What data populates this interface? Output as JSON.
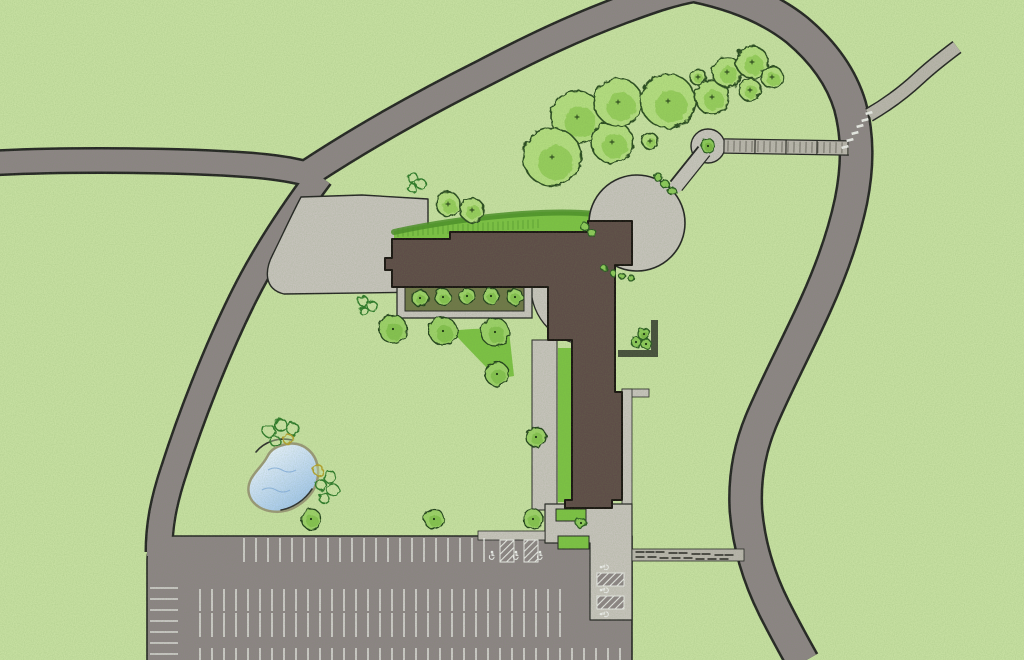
{
  "map": {
    "type": "landscape-site-plan",
    "canvas": {
      "width": 1024,
      "height": 660
    },
    "palette": {
      "grass": "#c7e0a2",
      "road": "#8d8486",
      "casing": "#242424",
      "plaza": "#c7c3bd",
      "building": "#5e4b48",
      "buildingOutline": "#1a1412",
      "lawnBright": "#7cc244",
      "lawnDark": "#4b8f28",
      "olive": "#6f7748",
      "wall": "#474f3d",
      "boardwalk": "#b9b4ad",
      "boardTick": "#5f5a55",
      "stall": "#e9e9e7",
      "dashDark": "#4c4946",
      "shore": "#9b9878",
      "ripple": "#86aede",
      "pondLight": "#f5faff",
      "pondMid": "#cfe2f7",
      "pondDeep": "#9dc3ea",
      "dot": "#1b3312",
      "ringGreen": "#2f7a2b",
      "ringYellow": "#b3a02e",
      "trees": {
        "canopy": {
          "fill": "#b4dd80",
          "inner": "#92cb58",
          "stroke": "#2c4b20"
        },
        "round": {
          "fill": "#9cd168",
          "inner": "#83c04c",
          "stroke": "#20401b"
        },
        "shrub": {
          "fill": "#8cc95a",
          "inner": "#7ab544",
          "stroke": "#2b5a22"
        }
      }
    },
    "layers": [
      {
        "name": "grass-field",
        "kind": "rect",
        "x": 0,
        "y": 0,
        "w": 1024,
        "h": 660,
        "fill": "grass"
      },
      {
        "name": "road-network",
        "kind": "roadnet",
        "casingW": 5,
        "paths": [
          {
            "id": "road-west",
            "d": "M-8,163 C70,159 180,160 250,165 C285,168 305,172 320,178",
            "w": 22
          },
          {
            "id": "road-southwest",
            "d": "M320,176 C293,212 266,252 244,296 C216,352 190,420 174,470 C163,503 159,527 159,552",
            "w": 24
          },
          {
            "id": "road-north",
            "d": "M310,172 C362,138 424,103 484,73 C534,47 574,28 622,10 C652,-1 672,-8 695,-12",
            "w": 25
          },
          {
            "id": "road-east",
            "d": "M695,-14 C738,-5 772,10 797,30 C822,51 841,76 850,106 C858,136 858,166 851,201 C843,239 830,273 816,304 C799,342 777,383 761,421 C749,450 744,479 746,511 C749,546 759,578 774,608 C784,628 794,646 803,662",
            "w": 30
          }
        ]
      },
      {
        "name": "parking-lot",
        "kind": "path",
        "d": "M147,662 L147,560 C147,545 156,537 173,536 L632,536 L632,662 Z",
        "fill": "road",
        "stroke": "casing",
        "sw": 1.6
      },
      {
        "name": "lot-entrance-blend",
        "kind": "path",
        "d": "M174,470 C163,503 159,527 159,556",
        "fill": "none",
        "stroke": "road",
        "sw": 24,
        "cap": "butt"
      },
      {
        "name": "driveway",
        "kind": "path",
        "d": "M301,197 L362,195 L428,199 L428,292 L284,294 C263,289 265,269 273,254 C281,238 291,216 301,197 Z",
        "fill": "plaza",
        "stroke": "casing",
        "sw": 1.4
      },
      {
        "name": "north-lawn",
        "kind": "path",
        "d": "M394,244 L394,231 C440,221 482,216 522,213 C552,211 576,211 594,213 L599,231 L591,241 L450,241 L450,244 Z",
        "fill": "lawnBright"
      },
      {
        "name": "north-lawn-shade",
        "kind": "path",
        "d": "M394,232 C440,222 482,217 522,214 C552,212 576,212 594,214",
        "fill": "none",
        "stroke": "lawnDark",
        "sw": 6,
        "op": 0.85
      },
      {
        "name": "hedge-ticks",
        "kind": "tickrow",
        "x1": 398,
        "x2": 540,
        "step": 5,
        "y1": 228,
        "y2": 219,
        "len": 9,
        "stroke": "lawnDark",
        "sw": 1,
        "op": 0.6
      },
      {
        "name": "circle-plaza",
        "kind": "circle",
        "cx": 637,
        "cy": 223,
        "r": 48,
        "fill": "plaza",
        "stroke": "casing",
        "sw": 1.6
      },
      {
        "name": "garden-node",
        "kind": "circle",
        "cx": 708,
        "cy": 146,
        "r": 17,
        "fill": "plaza",
        "stroke": "casing",
        "sw": 1.4
      },
      {
        "name": "node-link-casing",
        "kind": "path",
        "d": "M676,186 L704,151",
        "fill": "none",
        "stroke": "casing",
        "sw": 16,
        "cap": "butt"
      },
      {
        "name": "node-link",
        "kind": "path",
        "d": "M674,189 L706,149",
        "fill": "none",
        "stroke": "plaza",
        "sw": 13,
        "cap": "butt"
      },
      {
        "name": "boardwalk",
        "kind": "boardwalk",
        "x1": 724,
        "y1": 146,
        "x2": 849,
        "y2": 148,
        "w": 13
      },
      {
        "name": "ne-trail-casing",
        "kind": "path",
        "d": "M869,115 C888,104 904,92 919,78 C933,65 945,56 957,47",
        "fill": "none",
        "stroke": "casing",
        "sw": 15,
        "cap": "butt"
      },
      {
        "name": "ne-trail",
        "kind": "path",
        "d": "M869,115 C888,104 904,92 919,78 C933,65 945,56 957,47",
        "fill": "none",
        "stroke": "boardwalk",
        "sw": 12,
        "cap": "butt"
      },
      {
        "name": "crosswalk-marks",
        "kind": "dashes",
        "w": 7,
        "h": 2.6,
        "fill": "stall",
        "items": [
          [
            845,
            147,
            -15
          ],
          [
            850,
            140,
            -15
          ],
          [
            855,
            133,
            -15
          ],
          [
            860,
            126,
            -15
          ],
          [
            865,
            120,
            -15
          ],
          [
            869,
            113,
            -15
          ]
        ]
      },
      {
        "name": "terrace",
        "kind": "path",
        "d": "M589,287 L531,287 A58,58 0 0 0 589,345 Z",
        "fill": "plaza",
        "stroke": "casing",
        "sw": 1.3
      },
      {
        "name": "wing-walkway",
        "kind": "rect",
        "x": 532,
        "y": 340,
        "w": 25,
        "h": 170,
        "fill": "plaza",
        "stroke": "casing",
        "sw": 1
      },
      {
        "name": "wing-lawn-strip",
        "kind": "rect",
        "x": 558,
        "y": 348,
        "w": 13,
        "h": 154,
        "fill": "lawnBright"
      },
      {
        "name": "courtyard-lawn-wedge",
        "kind": "path",
        "d": "M452,331 C472,328 492,328 509,331 L514,376 L497,379 C481,361 465,346 452,331 Z",
        "fill": "lawnBright"
      },
      {
        "name": "planter-border-walk",
        "kind": "rect",
        "x": 397,
        "y": 279,
        "w": 135,
        "h": 39,
        "fill": "plaza",
        "stroke": "casing",
        "sw": 1.3
      },
      {
        "name": "planter-bed",
        "kind": "rect",
        "x": 405,
        "y": 286,
        "w": 119,
        "h": 25,
        "fill": "olive",
        "stroke": "casing",
        "sw": 1
      },
      {
        "name": "east-sidewalk-spur",
        "kind": "rect",
        "x": 622,
        "y": 389,
        "w": 27,
        "h": 8,
        "fill": "plaza",
        "stroke": "casing",
        "sw": 0.8
      },
      {
        "name": "east-sidewalk",
        "kind": "rect",
        "x": 622,
        "y": 389,
        "w": 10,
        "h": 123,
        "fill": "plaza",
        "stroke": "casing",
        "sw": 0.8
      },
      {
        "name": "garden-wall-vertical",
        "kind": "rect",
        "x": 651,
        "y": 320,
        "w": 7,
        "h": 37,
        "fill": "wall"
      },
      {
        "name": "garden-wall-horizontal",
        "kind": "rect",
        "x": 618,
        "y": 350,
        "w": 40,
        "h": 7,
        "fill": "wall"
      },
      {
        "name": "entry-plaza",
        "kind": "path",
        "d": "M545,504 L632,504 L632,620 L590,620 L590,543 L545,543 Z",
        "fill": "plaza",
        "stroke": "casing",
        "sw": 1.2
      },
      {
        "name": "entry-sidewalk-west",
        "kind": "rect",
        "x": 478,
        "y": 531,
        "w": 67,
        "h": 9,
        "fill": "plaza",
        "stroke": "casing",
        "sw": 0.8
      },
      {
        "name": "entry-crosswalk",
        "kind": "rect",
        "x": 632,
        "y": 549,
        "w": 112,
        "h": 12,
        "fill": "boardwalk",
        "stroke": "casing",
        "sw": 0.8
      },
      {
        "name": "entry-crosswalk-pavers",
        "kind": "dashes",
        "w": 9,
        "h": 2,
        "fill": "dashDark",
        "items": [
          [
            640,
            552,
            0
          ],
          [
            650,
            552,
            0
          ],
          [
            660,
            552,
            0
          ],
          [
            673,
            553,
            0
          ],
          [
            683,
            553,
            0
          ],
          [
            696,
            554,
            0
          ],
          [
            706,
            554,
            0
          ],
          [
            719,
            555,
            0
          ],
          [
            729,
            555,
            0
          ],
          [
            640,
            557,
            0
          ],
          [
            652,
            557,
            0
          ],
          [
            664,
            558,
            0
          ],
          [
            676,
            558,
            0
          ],
          [
            688,
            558,
            0
          ],
          [
            700,
            559,
            0
          ],
          [
            712,
            559,
            0
          ],
          [
            724,
            559,
            0
          ]
        ]
      },
      {
        "name": "entry-bed-north",
        "kind": "rect",
        "x": 556,
        "y": 509,
        "w": 30,
        "h": 12,
        "fill": "lawnBright",
        "stroke": "casing",
        "sw": 1
      },
      {
        "name": "entry-bed-south",
        "kind": "rect",
        "x": 558,
        "y": 536,
        "w": 31,
        "h": 13,
        "fill": "lawnBright",
        "stroke": "casing",
        "sw": 1
      },
      {
        "name": "building",
        "kind": "path",
        "d": "M392,239 L450,239 L450,232 L588,232 L588,221 L632,221 L632,265 L615,265 L615,392 L622,392 L622,500 L612,500 L612,508 L565,508 L565,500 L572,500 L572,340 L548,340 L548,287 L392,287 L392,270 L385,270 L385,258 L392,258 Z",
        "fill": "building",
        "stroke": "buildingOutline",
        "sw": 2
      },
      {
        "name": "parking-stall-lines",
        "kind": "linerows",
        "stroke": "stall",
        "sw": 1.6,
        "op": 0.85,
        "rows": [
          {
            "o": "v",
            "from": 244,
            "to": 484,
            "step": 12,
            "a1": 538,
            "a2": 562
          },
          {
            "o": "v",
            "from": 200,
            "to": 568,
            "step": 12,
            "a1": 589,
            "a2": 611
          },
          {
            "o": "v",
            "from": 200,
            "to": 568,
            "step": 12,
            "a1": 613,
            "a2": 637
          },
          {
            "o": "v",
            "from": 200,
            "to": 628,
            "step": 12,
            "a1": 648,
            "a2": 662
          },
          {
            "o": "h",
            "from": 588,
            "to": 656,
            "step": 11,
            "a1": 150,
            "a2": 178
          }
        ]
      },
      {
        "name": "ada-hatch-stalls",
        "kind": "hatch",
        "items": [
          [
            500,
            540,
            14,
            22
          ],
          [
            524,
            540,
            14,
            22
          ],
          [
            597,
            573,
            27,
            13
          ],
          [
            597,
            596,
            27,
            13
          ]
        ]
      },
      {
        "name": "ada-symbols",
        "kind": "wheelchair",
        "items": [
          [
            492,
            555,
            0
          ],
          [
            516,
            555,
            0
          ],
          [
            540,
            555,
            0
          ],
          [
            604,
            567,
            -90
          ],
          [
            604,
            590,
            -90
          ],
          [
            604,
            614,
            -90
          ]
        ]
      },
      {
        "name": "pond",
        "kind": "pond",
        "outline": "M287,444 C303,441 317,453 318,470 C319,487 309,499 297,506 C286,513 270,514 259,507 C248,500 246,489 251,479 C256,470 263,465 267,457 C271,449 277,446 287,444 Z",
        "arcs": [
          "M256,452 C264,442 278,437 292,440",
          "M312,489 C305,500 293,508 281,510"
        ],
        "ripples": [
          "M268,470 q7,-4 14,0 q7,4 14,0",
          "M262,490 q7,-4 14,0 q7,4 14,0"
        ]
      },
      {
        "name": "pond-shrub-rings",
        "kind": "rings",
        "items": [
          [
            269,
            431,
            6,
            "g"
          ],
          [
            281,
            425,
            6,
            "g"
          ],
          [
            293,
            429,
            6,
            "g"
          ],
          [
            275,
            441,
            5,
            "g"
          ],
          [
            288,
            439,
            5,
            "y"
          ],
          [
            318,
            470,
            5,
            "y"
          ],
          [
            330,
            477,
            6,
            "g"
          ],
          [
            321,
            485,
            5,
            "g"
          ],
          [
            333,
            490,
            6,
            "g"
          ],
          [
            324,
            498,
            5,
            "g"
          ]
        ]
      },
      {
        "name": "field-shrub-rings",
        "kind": "rings",
        "items": [
          [
            413,
            178,
            5,
            "g"
          ],
          [
            421,
            184,
            5,
            "g"
          ],
          [
            412,
            188,
            4,
            "g"
          ],
          [
            363,
            301,
            5,
            "g"
          ],
          [
            372,
            306,
            5,
            "g"
          ],
          [
            364,
            311,
            4,
            "g"
          ]
        ]
      },
      {
        "name": "north-grove-trees",
        "kind": "trees",
        "style": "canopy",
        "items": [
          [
            577,
            117,
            26
          ],
          [
            552,
            157,
            29
          ],
          [
            612,
            142,
            21
          ],
          [
            618,
            102,
            24
          ],
          [
            668,
            101,
            27
          ],
          [
            712,
            97,
            17
          ],
          [
            727,
            72,
            15
          ],
          [
            752,
            62,
            16
          ],
          [
            772,
            77,
            11
          ],
          [
            750,
            90,
            11
          ],
          [
            698,
            77,
            8
          ],
          [
            650,
            141,
            8
          ],
          [
            448,
            204,
            12
          ],
          [
            472,
            210,
            12
          ]
        ]
      },
      {
        "name": "courtyard-trees",
        "kind": "trees",
        "style": "round",
        "items": [
          [
            393,
            329,
            14
          ],
          [
            443,
            331,
            14
          ],
          [
            495,
            332,
            14
          ],
          [
            497,
            374,
            12
          ],
          [
            536,
            437,
            10
          ],
          [
            311,
            519,
            10
          ],
          [
            434,
            519,
            10
          ],
          [
            533,
            519,
            10
          ]
        ]
      },
      {
        "name": "planter-row-trees",
        "kind": "trees",
        "style": "round",
        "items": [
          [
            420,
            298,
            8
          ],
          [
            443,
            297,
            8
          ],
          [
            467,
            296,
            8
          ],
          [
            491,
            296,
            8
          ],
          [
            515,
            297,
            8
          ]
        ]
      },
      {
        "name": "small-shrubs",
        "kind": "trees",
        "style": "shrub",
        "items": [
          [
            708,
            146,
            7
          ],
          [
            585,
            227,
            4
          ],
          [
            592,
            233,
            4
          ],
          [
            644,
            334,
            6
          ],
          [
            636,
            342,
            5
          ],
          [
            646,
            344,
            5
          ],
          [
            581,
            523,
            5
          ],
          [
            658,
            177,
            4
          ],
          [
            665,
            184,
            4
          ],
          [
            672,
            191,
            4
          ],
          [
            604,
            268,
            3
          ],
          [
            613,
            273,
            3
          ],
          [
            622,
            276,
            3
          ],
          [
            631,
            278,
            3
          ]
        ]
      },
      {
        "name": "print-grain",
        "kind": "grain",
        "opacity": 0.4
      }
    ]
  }
}
